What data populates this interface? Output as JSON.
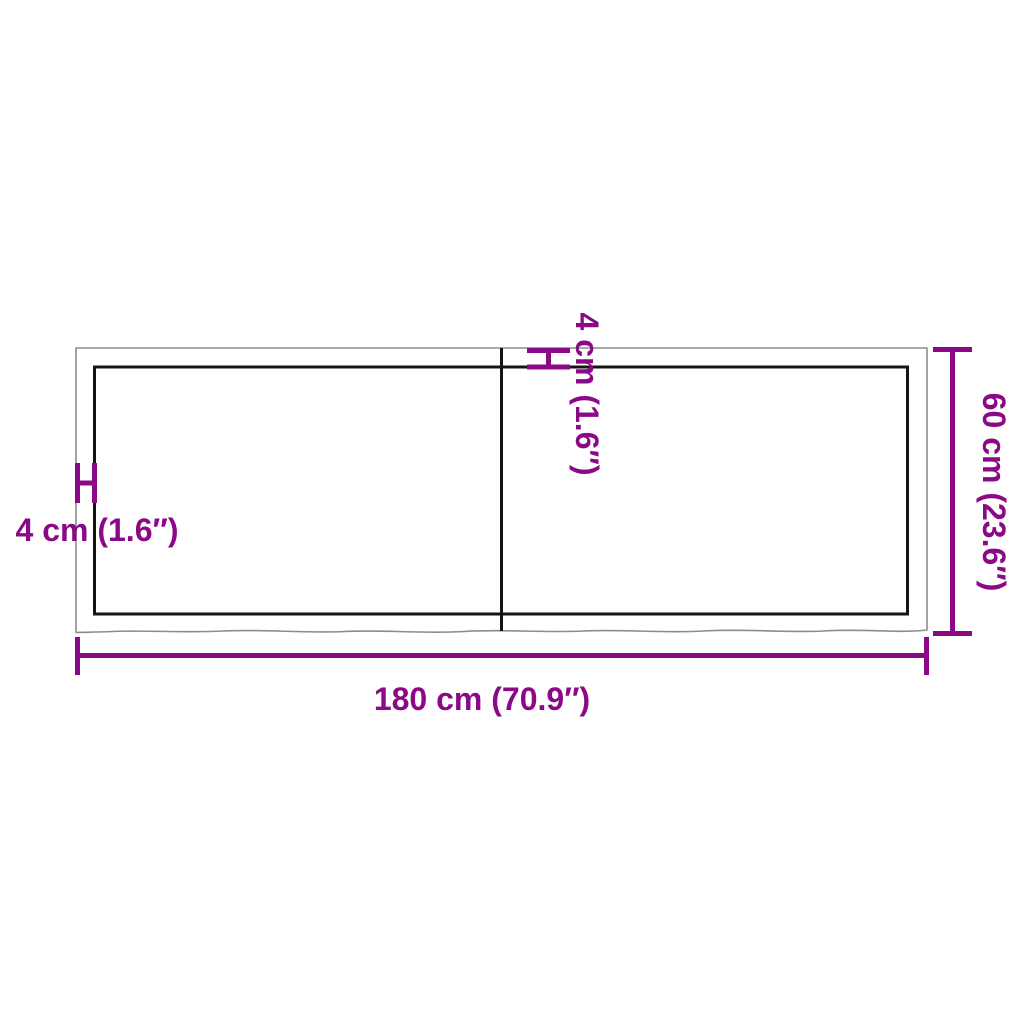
{
  "colors": {
    "accent": "#8B0986",
    "outline": "#8C8C8C",
    "edge": "#141414",
    "background": "#FFFFFF"
  },
  "diagram": {
    "kind": "tabletop-dimension-drawing",
    "panels": 2,
    "dimensions": {
      "width": {
        "label": "180 cm (70.9″)",
        "cm": 180,
        "inches": 70.9
      },
      "depth": {
        "label": "60 cm (23.6″)",
        "cm": 60,
        "inches": 23.6
      },
      "thickness_top": {
        "label": "4 cm (1.6″)",
        "cm": 4,
        "inches": 1.6
      },
      "thickness_left": {
        "label": "4 cm (1.6″)",
        "cm": 4,
        "inches": 1.6
      }
    }
  }
}
